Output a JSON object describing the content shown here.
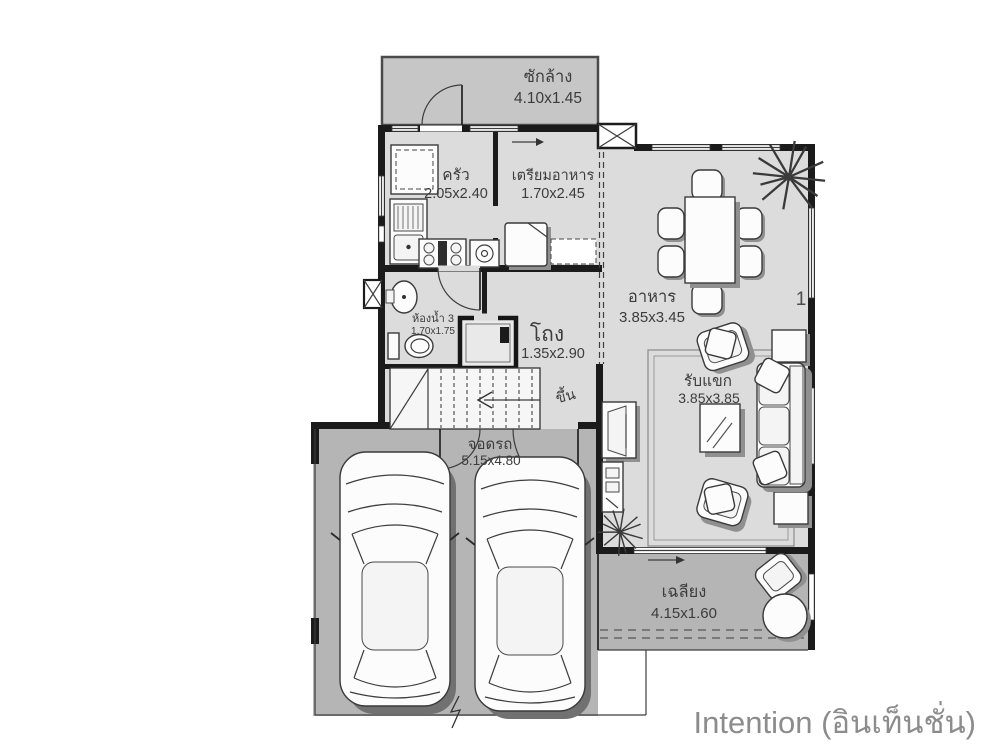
{
  "title": "Intention (อินเท็นชั่น)",
  "plan": {
    "laundry": {
      "name": "ซักล้าง",
      "size": "4.10x1.45"
    },
    "kitchen": {
      "name": "ครัว",
      "size": "2.05x2.40"
    },
    "prep": {
      "name": "เตรียมอาหาร",
      "size": "1.70x2.45"
    },
    "dining": {
      "name": "อาหาร",
      "size": "3.85x3.45"
    },
    "bathroom": {
      "name": "ห้องน้ำ 3",
      "size": "1.70x1.75"
    },
    "hall": {
      "name": "โถง",
      "size": "1.35x2.90"
    },
    "stairs": {
      "label": "ขึ้น"
    },
    "living": {
      "name": "รับแขก",
      "size": "3.85x3.85"
    },
    "parking": {
      "name": "จอดรถ",
      "size": "5.15x4.80"
    },
    "porch": {
      "name": "เฉลียง",
      "size": "4.15x1.60"
    },
    "grid_marker": "1"
  },
  "icons": {
    "stairs_direction": "left-arrow",
    "porch_door_swing": "right-arrow",
    "window_swing": "right-arrow",
    "section_break": "zigzag"
  },
  "colors": {
    "wall": "#1b1b1b",
    "floor_indoor": "#dcdcdc",
    "floor_outdoor": "#b5b5b5",
    "floor_laundry": "#c6c6c6",
    "label": "#3c3c3c",
    "title": "#8c8c8c"
  }
}
